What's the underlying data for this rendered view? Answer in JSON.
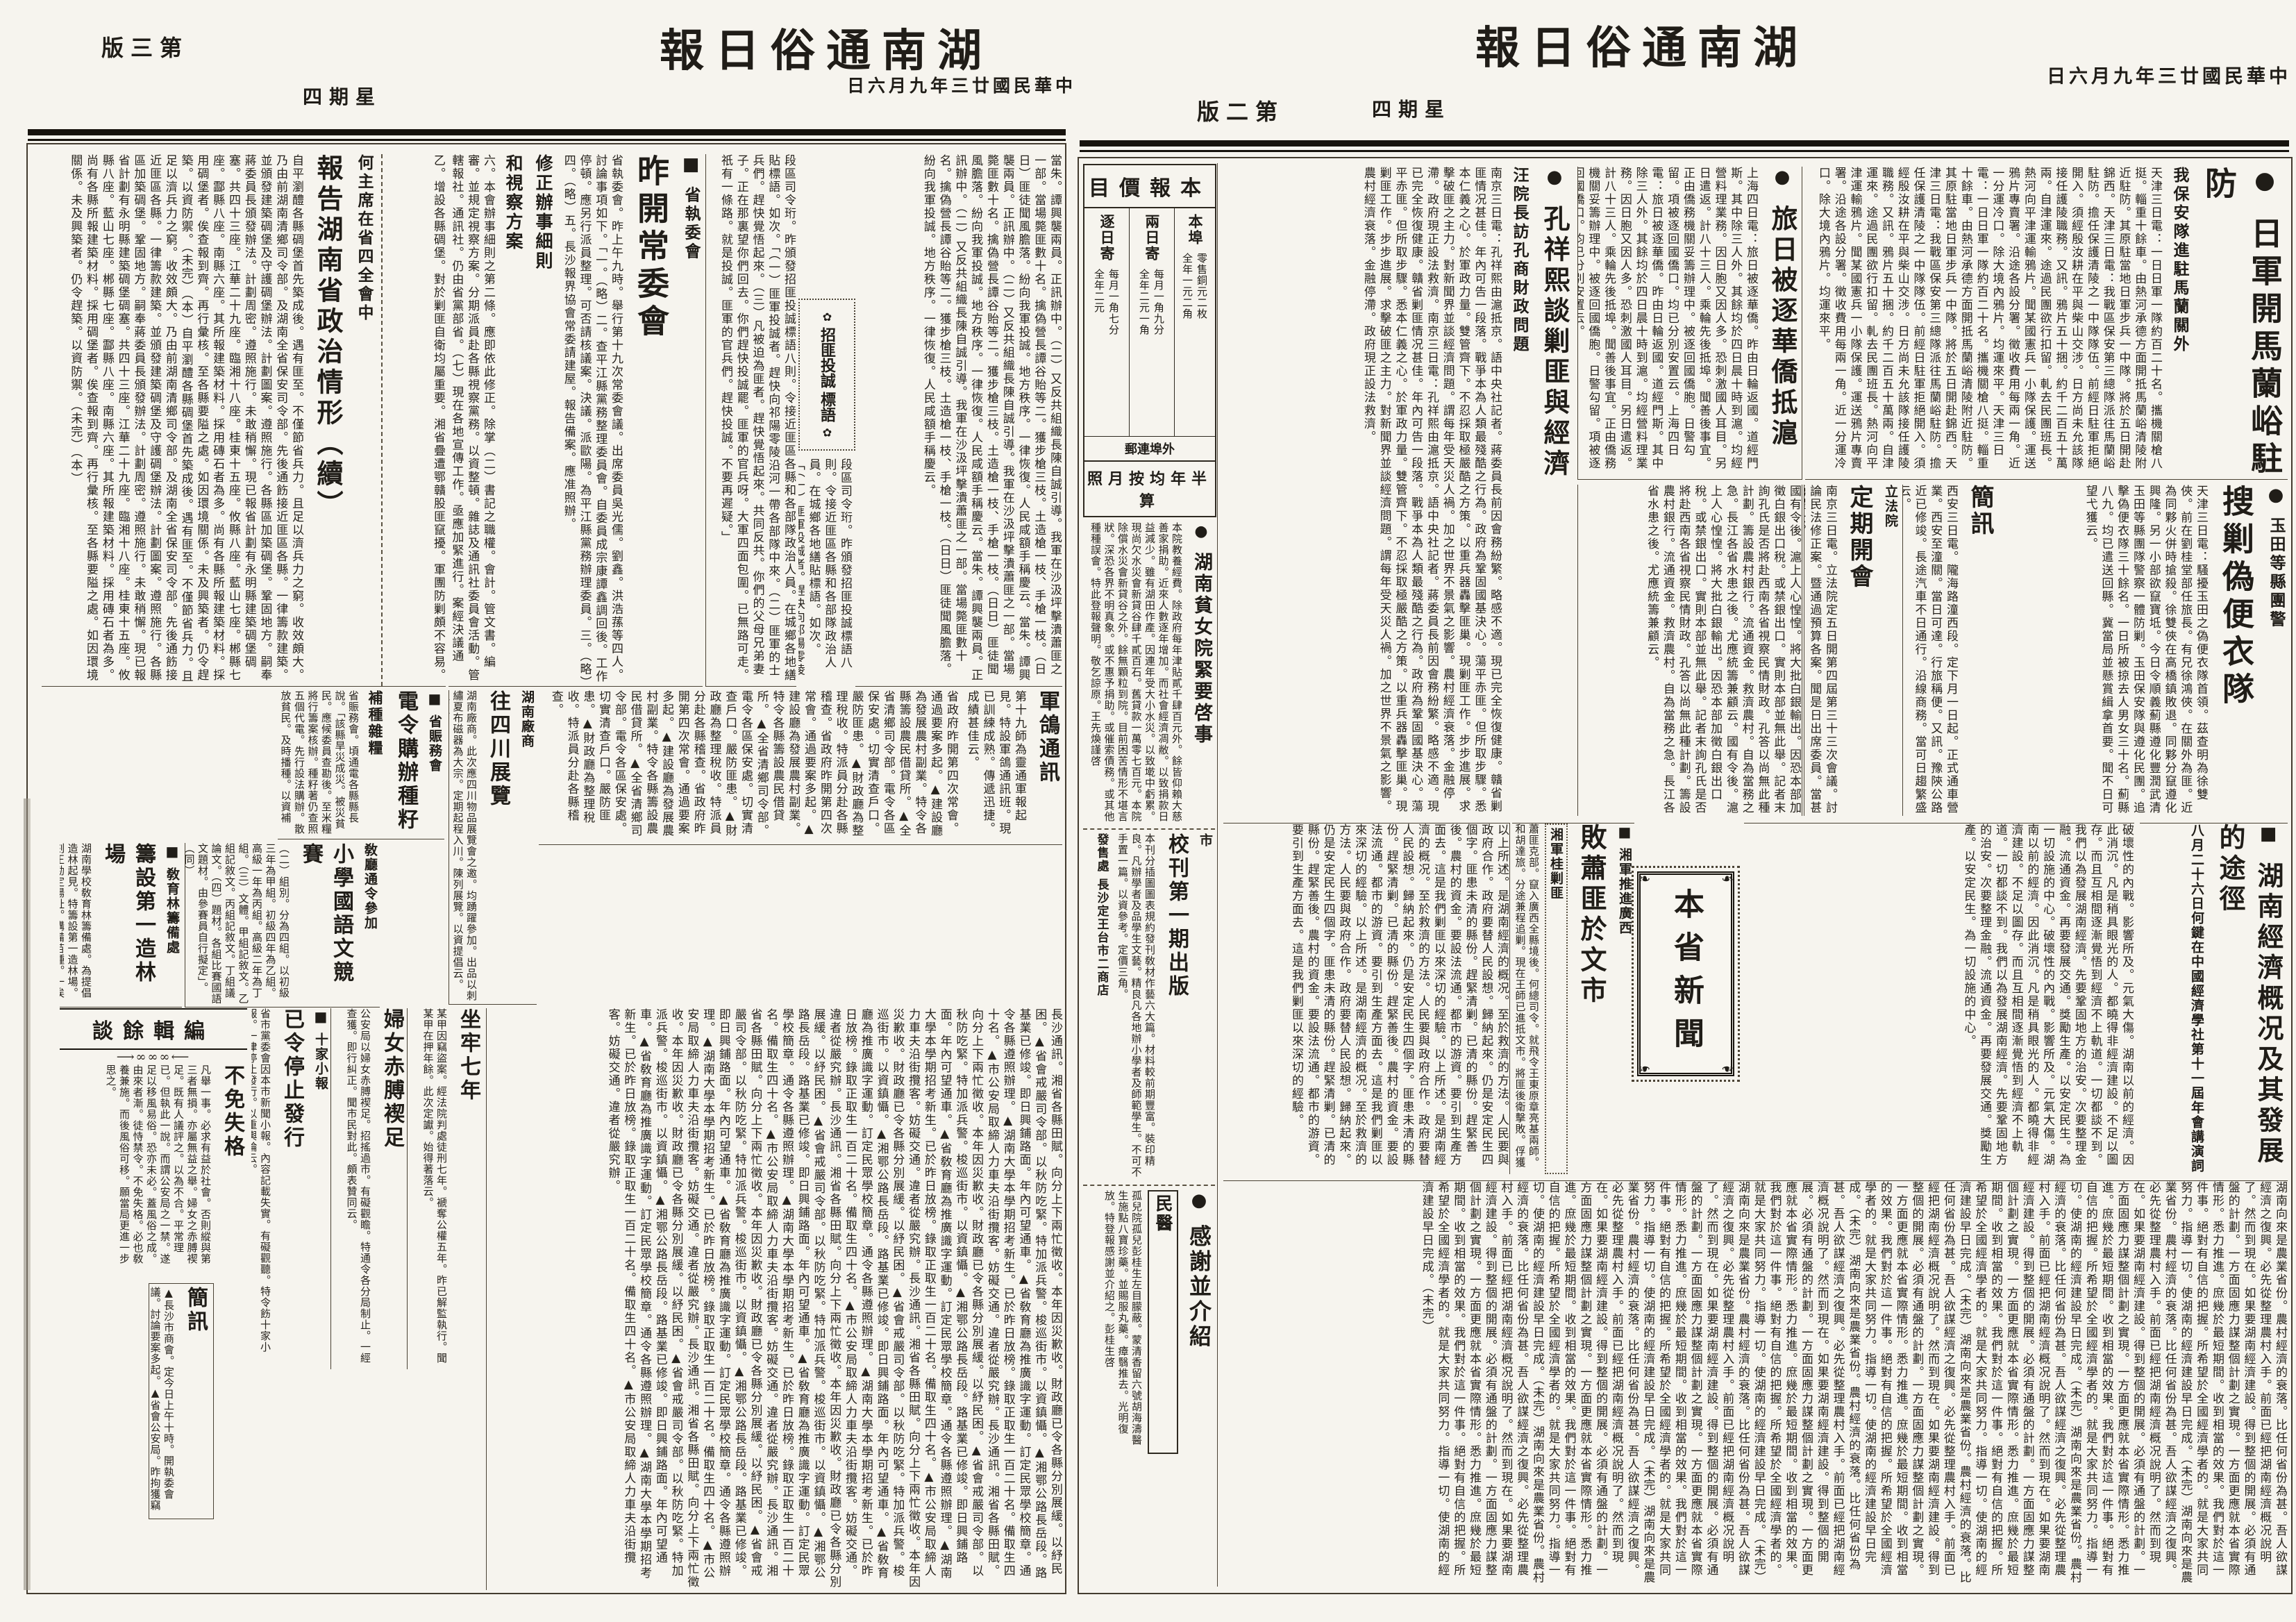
{
  "meta": {
    "paper_name": "湖南通俗日報",
    "date_line": "中華民國廿三年九月六日",
    "weekday": "星期四",
    "page2_label": "第二版",
    "page3_label": "第三版"
  },
  "icons": {
    "circle_marker": "●",
    "square_marker": "■",
    "flower": "✿",
    "leaf": "❧",
    "deco_line": "⟶∞∞∞⟵"
  },
  "price": {
    "title": "本報價目",
    "col_local": "本埠",
    "col_mail": "外埠連郵",
    "mail_daily": "逐日寄",
    "mail_alt": "兩日寄",
    "local_price": "零售銅元二枚\n全年一元二角",
    "daily_price": "每月一角七分\n全年二元",
    "alt_price": "每月一角九分\n全年二元一角",
    "footer": "半年均按月照算"
  },
  "p2": {
    "jun": {
      "headline": "日軍開馬蘭峪駐防",
      "kicker": "我保安隊進駐馬蘭關外",
      "body": "天津三日電：一日日軍一隊約百二十名。攜機關槍八挺。輜重十餘車。由熱河承德方面開抵馬蘭峪清陵附近駐防。其原駐當地日軍步兵一中隊。將於五日開赴錦西。天津三日電：我戰區保安第三總隊派往馬蘭峪駐防。擔任保護清陵之一中隊隊伍。前經日駐軍拒絕開入。須經殷汝耕在平與柴山交涉。日方尚未允該隊接任護陵職務。又訊。鴉片五十捆。約千二百五十萬兩。自津運來。途過民團欲行扣留。軋去民團班長。熱河向平津運輸鴉片。聞某國憲兵一小隊保護。運送鴉片專賣署。沿途各設分署。徵收費用每兩一角。近一分運冷口。除大境內鴉片。均運來平。"
    },
    "luri": {
      "headline": "旅日被逐華僑抵滬",
      "body": "上海四日電：旅日被逐華僑。昨由日輪返國。道經門斯。其中除三人外。其餘均於四日晨十時到滬。均經營料理業務。因日胞又因人多。恐刺激國人耳目。另日遣返。計八十三人。乘輪先後抵埠。聞善後事宜。正由僑務機關妥籌辦理中。被逐回國僑胞。日警勾留。項被逐回國僑口。均已分別安置云。"
    },
    "kong": {
      "headline": "孔祥熙談剿匪與經濟",
      "kicker": "汪院長訪孔商財政問題",
      "body": "南京三日電：孔祥熙由滬抵京。語中央社記者。蔣委員長前因會務紛繁。略感不適。現已完全恢復健康。贛省剿匪情况甚佳。年內可告一段落。戰爭本為人類最殘酷之行為。政府為鞏固國基決心。蕩平赤匪。但所取步驟。悉本仁義之心。於軍政力量。雙管齊下。不忍採取極嚴酷之方策。以重兵器轟擊匪巢。現剿匪工作。步步進展。求擊破匪之主力。對新聞界並談經濟問題。謂每年受天災人禍。加之世界不景氣之影響。農村經濟衰落。金融停滯。政府現正設法救濟。",
      "body2": "國有令後。滬上人心惶惶。將大批白銀輸出。因恐本部加徵白銀出口稅。或禁銀出口。實則本部並無此舉。記者末詢孔氏是否將赴西南各省視察民情財政。孔答以尚無此種計劃。籌設農村銀行。流通資金。救濟農村。自為當務之急。長江各省水患之後。尤應統籌兼顧云。"
    },
    "yutian": {
      "kicker": "玉田等縣團警",
      "headline": "搜剿偽便衣隊",
      "body": "天津三日電：騷擾玉田之偽便衣隊首領。茲查明為徐雙俠。前在劉桂堂部任旅長。有兄徐鴻俠。在關外為匪。近為同夥火併時搶殺。徐雙俠在高橋鎮敗退。同夥分竄遵化興隆。另一小部欲竄寶坻。今日令順義薊縣遵化豐潤武清玉田等縣團隊警察一體防剿。玉田保安隊與遵化民團。追擊偽便衣隊三十餘名。一日所被掠去人男女三十名。薊縣八九。均已遣送回縣。冀當局並懸賞緝拿首要。聞不日可望弋獲云。"
    },
    "jianxun": {
      "headline": "簡訊",
      "body": "西安三日電。隴海路潼西段。定下月一日起。正式通車營業。西安至潼關。當日可達。行旅稱便。又訊。豫陝公路近已修竣。長途汽車不日通行。沿線商務。當可日趨繁盛云。"
    },
    "dingqi": {
      "kicker": "立法院",
      "headline": "定期開會",
      "body": "南京三日電。立法院定五日開第四屆第三十三次會議。討論民法修正案。暨通過預算各案。聞是日出席委員。當甚踴躍云。"
    },
    "econ": {
      "headline": "湖南經濟概况及其發展的途徑",
      "kicker": "八月二十六日何鍵在中國經濟學社第十一屆年會講演詞",
      "body": "破壞性的內戰。影響所及。元氣大傷。湖南以前的經濟。因此消沉。凡是稍具眼光的人。都曉得非經濟建設。不足以圖存。而且互相間逐漸覺悟到經濟不上軌道。一切都談不到。我們以為發展湖南經濟。先要鞏固地方的治安。次要整理金融。流通資金。再要發展交通。獎勵生產。以安定民生。為一切設施的中心。",
      "body2": "湖南向來是農業省份。農村經濟的衰落。比任何省份為甚。吾人欲謀經濟之復興。必先從整理農村入手。前面已經把湖南經濟概况說明了。然而到現在。如果要湖南經濟建設。得到整個的開展。必須有通盤的計劃。一方面固應力謀整個計劃之實現。一方面更應就本省實際情形。悉力推進。庶幾於最短期間。收到相當的效果。我們對於這一件事。絕對有自信的把握。所希望於全國經濟學者的。就是大家共同努力。指導一切。使湖南的經濟建設早日完成。（未完）",
      "body3": "以上所述。是湖南經濟的概况。至於救濟的方法。人民要與政府合作。政府要替人民設想。歸納起來。仍是安定民生四個字。匪患未清的縣份。趕緊清剿。已清的縣份。趕緊善後。農村的資金。要設法流通。都市的游資。要引到生產方面去。這是我們剿匪以來深切的經驗。"
    },
    "baixiao": {
      "kicker": "湘軍推進廣西",
      "headline": "敗蕭匪於文市",
      "sub": "湘軍桂剿匪",
      "body": "蕭匪克部。竄入廣西全縣境後。何總司令。就飛令王東原章亮基兩師。和胡達旅。分途兼程追剿。現在王師已進抵文市。將匪後衛擊敗。俘獲甚眾。匪向灌陽邊境逃竄。我軍正跟蹤窮追。不使漏網云。（專電）"
    },
    "box_label": "本省新聞",
    "pinnv": {
      "headline": "湖南貧女院緊要啓事",
      "body": "本院教養經費。除政府每年津貼貳千肆百元外。餘皆仰賴大慈善家捐助。近來人數逐年增加。而社會經濟凋敝。以致捐款日益減少。雖有湖田作產。因連年受大小水災。以致墘中虧累。現尚欠水災會新貸谷肆千貳百石。舊貸款一萬零七百元。本院除償水災會新貸谷之外。餘無顆粒到院。目前困苦情形不堪言狀。深恐各界不明真象。或不惠予捐助。或催索債務。或其他種種誤會。特此登報聲明。敬乞諒原。王先煥謹啓"
    },
    "xiaokan": {
      "kicker": "市",
      "headline": "校刊第一期出版",
      "body": "本刊分插圖圖表規約發刊敎材作藝六大篇。材料較前期豐富。裝印精良。凡辦學者及品學生文藝。精良凡各地辦小學者及師範學生。不可不手置一篇。以資參考。定價三角。",
      "seller": "發售處 長沙定王台市二商店"
    },
    "ganxie": {
      "headline": "感謝並介紹",
      "sub": "民醫",
      "body": "孤兒院孤兒彭桂生左目朦蔽。蒙清香留六號胡海濤醫生施點八寶珍藥。並賜服丸藥。瘴翳推去。光明復放。特登報感謝並介紹之。彭桂生啓"
    }
  },
  "p3": {
    "flow1": "當朱。譚興襲兩員。正訊辦中。（二）又反共組織長陳自誠引導。我軍在沙汲坪擊潰蕭匪之一部。當場斃匪數十名。擒偽營長譚谷貽等二。獲步槍三枝。土造槍一枝、手槍一枝。（日日）匪徒聞風膽落。紛向我軍投誠。地方秩序。一律恢復。人民咸額手稱慶云。",
    "orn": {
      "label": "招匪投誠",
      "sub": "標語"
    },
    "flow2": "段區司令珩。昨頒發招匪投誠標語八則。令接近匪區各縣和各部隊政治人員。在城鄉各地繕貼標語。如次。「（一）匪軍投誠者。趕快向祁陽零陵沿河一帶各部隊中來。（二）匪軍的士兵們。趕快覺悟起來。（三）凡被迫為匪者。趕快覺悟起來。共同反共。你們的父母兄弟妻子。正在那裏望你們回去。你們趕快投誠罷。匪軍的官兵呀。大軍四面包圍。已無路可走。祇有一條路。就是投誠。匪軍的官兵們。趕快投誠。不要再遲疑。」",
    "zhixing": {
      "kicker": "省執委會",
      "headline": "昨開常委會",
      "body": "省執委會。昨上午九時。舉行第十九次常委會議。出席委員吳光儒。劉鑫。洪浩蓀等四人。討論事項如下。「一。（略）二。查平江縣黨務整理委員會。自委員成宗康譚鑫調回後。工作停頓。應另行派員整理。可否請核議案。決議。派歐陽。為平江縣黨務辦理委員。三。（略）四。（略）五。長沙報界協會常委請建屋。報告備案。應准照辦。",
      "sub1": "修正辦事細則",
      "sub2": "和視察方案",
      "body2": "六。本會辦事細則之第二條。應即依此修正。除掌（二）書記之職權。會計。管文書。編審。並規定視察方案。分期派員赴各縣視察黨務。以資整頓。雜誌及通訊社委員會活動。管轄報社。通訊社。仍由省黨部省。（七）現在各地宣傳工作。亟應加緊進行。案經決議通過。即日分行照辦云。"
    },
    "hezhuxi": {
      "lead": "乙。增設各縣碉堡。對於剿匪自衛均屬重要。湘省疊遭鄂贛股匪竄擾。軍團防剿頗不容易。",
      "kicker": "何主席在省四全會中",
      "headline": "報告湖南省政治情形（續）",
      "body": "自平瀏醴各縣碉堡首先築成後。遇有匪至。不僅節省兵力。且足以濟兵力之窮。收效頗大。乃由前湖南清鄉司令部。及湖南全省保安司令部。先後通飭接近匪區各縣。一律籌款建築。並頒發建築碉堡及守護碉堡辦法。計劃圖案。遵照施行。各縣區加築碉堡。鞏固地方。嗣奉蔣委員長頒發辦法。計劃周密。遵照施行。未敢稍懈。現已報省計劃有永明縣建築碉堡碉塞。共四十三座。江華二十九座。臨湘十八座。桂東十五座。攸縣八座。藍山七座。郴縣七座。酃縣八座。南縣六座。其所報建築材料。採用磚石者為多。尚有各縣所報建築材料。採用碉堡者。俟查報到齊。再行彙核。至各縣要隘之處。如因環境關係。未及興築者。仍令趕築。以資防禦。（未完）（本）"
    },
    "zhenwu": {
      "kicker": "省賑務會",
      "headline": "電令購辦種籽",
      "sub": "補種雜糧",
      "body": "省賑務會。頃通電各縣縣長說。「該縣旱災成災。被災貧民。應候委員查勘後。至米糧將行籌案核辦。種籽著仍查照五個代電。先行設法購辦。散放貧民。及時播種。以資補救。」（正）"
    },
    "junge": {
      "headline": "軍鴿通訊",
      "body": "第十九師為靈通軍報起見。特設軍鴿通訊班。現已訓練成熟。傳遞迅捷。成績甚佳云。"
    },
    "misc1": "省政府昨開第四次常會。通過要案多起。▲建設廳為發展農村副業。特令各縣籌設農民借貸所。▲全省清鄉司令部。電令各區保安處。切實清查戶口。嚴防匪患。▲財政廳為整理稅收。特派員分赴各縣稽查。",
    "zaolin": {
      "kicker": "敎育林籌備處",
      "headline": "籌設第一造林場",
      "body": "湖南學校敎育林籌備處。為提倡造林起見。特籌設第一造林場。刻正勘定場址。購備苗種。一俟籌備就緒。即行興工云。（同）"
    },
    "guoyu": {
      "kicker": "敎廳通令參加",
      "headline": "小學國語文競賽",
      "body": "（二）組別。分為四組。以初級三年為甲組。初級四年為乙組。高級一年為丙組。高級二年為丁組。（三）文體。甲組記敘文。乙組記敘文。丙組記敘文。丁組議論文。（四）題材。各組比賽國語文題材。由參賽員自行擬定」。（同）"
    },
    "sichuan": {
      "kicker": "湖南廠商",
      "headline": "往四川展覽",
      "body": "湖南廠商。此次應四川物品展覽會之邀。均踴躍參加。出品以刺繡夏布磁器為大宗。定期起程入川。陳列展覽。以資提倡云。（商）"
    },
    "zuolao": {
      "headline": "坐牢七年",
      "body": "某甲因竊盜案。經法院判處徒刑七年。褫奪公權五年。昨已解監執行。聞某甲在押年餘。此次定讞。始得著落云。"
    },
    "funv": {
      "headline": "婦女赤膊褉足",
      "body": "公安局以婦女赤膊褉足。招搖過市。有礙觀瞻。特通令各分局制止。一經查獲。即行糾正。聞市民對此。頗表贊同云。"
    },
    "shibao": {
      "kicker": "十家小報",
      "headline": "已令停止發行",
      "body": "省市黨委會因本市新聞小報。內容記載失實。有礙觀聽。特令飭十家小報。一律停止發行。以重輿論云。"
    },
    "editorial": {
      "title": "編輯餘談",
      "sub": "不免失格",
      "body": "凡舉一事。必求有益於社會。否則縱與第三者無損。亦屬無益之舉。婦女之赤膊褉足。既有人議評之。以為不合。平常理已。但執此一說。而謂公安局之一禁。遂足以移風易俗。恐亦未必。蓋風俗之成。由來者漸。徒恃禁令。不免失格。必也敎養兼施。而後風俗可移。願當局更進一步思之。"
    },
    "jianxun": {
      "headline": "簡訊",
      "body": "▲長沙市商會。定今日上午十時。開執委會議。討論要案多起。▲省會公安局。昨拘獲竊犯三名。解送法院訊辦。▲長沙市自治籌備處。已組設完竣。日內即可成立云。"
    },
    "misc2": "長沙通訊。湘省各縣田賦。向分上下兩忙徵收。本年因災歉收。財政廳已令各縣分別展緩。以紓民困。▲省會戒嚴司令部。以秋防吃緊。特加派兵警。梭巡街市。以資鎮懾。▲湘鄂公路長岳段。路基業已修竣。即日興鋪路面。年內可望通車。▲省敎育廳為推廣識字運動。訂定民眾學校簡章。通令各縣遵照辦理。▲湖南大學本學期招考新生。已於昨日放榜。錄取正取生一百二十名。備取生四十名。▲市公安局取締人力車夫沿街攬客。妨礙交通。違者從嚴究辦。"
  }
}
